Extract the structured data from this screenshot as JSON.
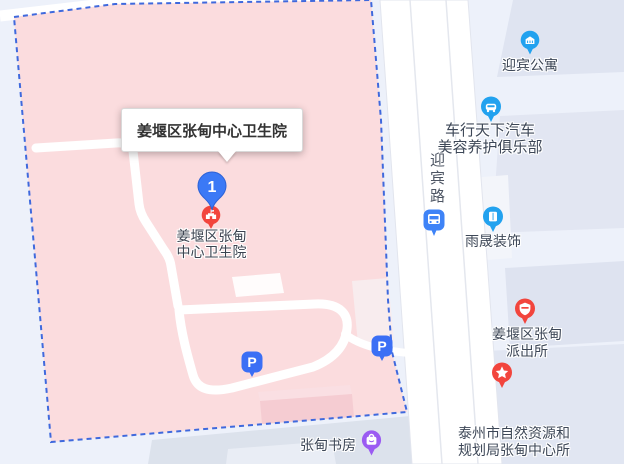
{
  "map": {
    "tooltip": {
      "text": "姜堰区张甸中心卫生院"
    },
    "marker": {
      "number": "1",
      "label_line1": "姜堰区张甸",
      "label_line2": "中心卫生院"
    },
    "road": {
      "name": "迎宾路"
    },
    "parking": {
      "label": "P"
    },
    "pois": [
      {
        "id": "yingbin-apartment",
        "lines": [
          "迎宾公寓"
        ]
      },
      {
        "id": "car-service-club",
        "lines": [
          "车行天下汽车",
          "美容养护俱乐部"
        ]
      },
      {
        "id": "yusheng-decoration",
        "lines": [
          "雨晟装饰"
        ]
      },
      {
        "id": "police-station",
        "lines": [
          "姜堰区张甸",
          "派出所"
        ]
      },
      {
        "id": "planning-bureau",
        "lines": [
          "泰州市自然资源和",
          "规划局张甸中心所"
        ]
      },
      {
        "id": "zhangdian-study",
        "lines": [
          "张甸书房"
        ]
      }
    ],
    "colors": {
      "area_fill": "#fbdcde",
      "area_border": "#3f69dd",
      "background": "#edf1fa",
      "marker_blue": "#3b79f6",
      "poi_red": "#f2453d",
      "poi_blue": "#22a2ef",
      "poi_purple": "#9b5bf2",
      "parking_blue": "#3b6ff5",
      "bus_blue": "#3e83f7"
    }
  }
}
